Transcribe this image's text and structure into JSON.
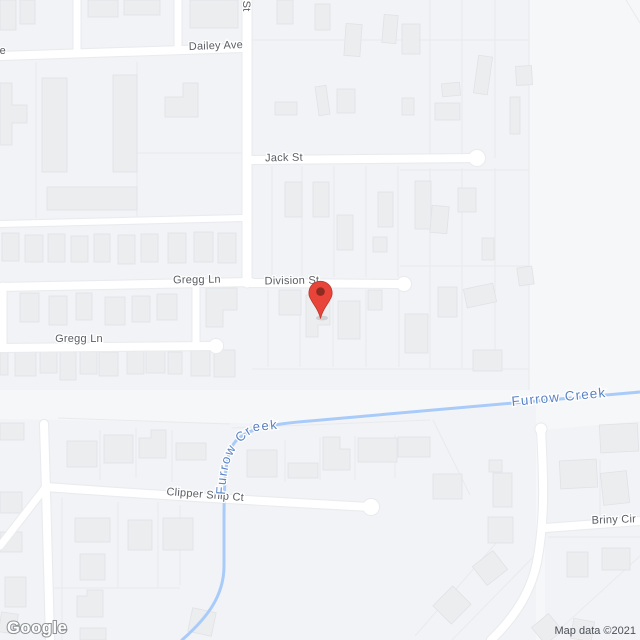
{
  "title": "Map",
  "logo": {
    "text": "Google"
  },
  "attribution": {
    "text": "Map data ©2021"
  },
  "pin": {
    "name": "red-location-pin",
    "color": "#e8443a",
    "inner_color": "#8e2b21"
  },
  "water": {
    "name": "Furrow Creek"
  },
  "colors": {
    "background": "#f6f7f9",
    "block": "#f2f3f6",
    "building": "#ebedef",
    "building_border": "#e0e2e6",
    "road": "#ffffff",
    "road_casing": "#e9ebee",
    "parcel_line": "#e8eaec",
    "creek": "#a9cbf9",
    "street_label": "#595d63",
    "water_label": "#5b82c4"
  },
  "street_labels": [
    {
      "id": "dailey-ave",
      "text": "Dailey Ave",
      "x": 216,
      "y": 49,
      "rotate": -2,
      "anchor": "middle"
    },
    {
      "id": "jack-st",
      "text": "Jack St",
      "x": 284,
      "y": 161,
      "rotate": -1,
      "anchor": "middle"
    },
    {
      "id": "gregg-ln-top",
      "text": "Gregg Ln",
      "x": 197,
      "y": 283,
      "rotate": -1,
      "anchor": "middle"
    },
    {
      "id": "division-st",
      "text": "Division St",
      "x": 292,
      "y": 284,
      "rotate": -1,
      "anchor": "middle"
    },
    {
      "id": "gregg-ln-bottom",
      "text": "Gregg Ln",
      "x": 79,
      "y": 342,
      "rotate": 0,
      "anchor": "middle"
    },
    {
      "id": "clipper-ship-ct",
      "text": "Clipper Ship Ct",
      "x": 205,
      "y": 498,
      "rotate": 4.5,
      "anchor": "middle"
    },
    {
      "id": "briny-cir",
      "text": "Briny Cir",
      "x": 614,
      "y": 523,
      "rotate": -2,
      "anchor": "middle"
    },
    {
      "id": "vertical-st-partial",
      "text": "n St",
      "x": 243,
      "y": -9,
      "rotate": 90,
      "anchor": "start"
    },
    {
      "id": "left-edge-fragment",
      "text": "e",
      "x": 6,
      "y": 54,
      "rotate": 0,
      "anchor": "end"
    }
  ],
  "water_labels": {
    "right": {
      "text": "Furrow Creek",
      "x": 512,
      "y": 406,
      "rotate": -5.5
    },
    "along_creek": {
      "text": "Furrow Creek"
    }
  },
  "features": {
    "blocks": [
      "M0,0 L529,0 L529,390 L0,390 Z",
      "M0,419 L300,424 L536,403 L536,640 L0,640 Z",
      "M545,430 L640,421 L640,640 L545,640 Z"
    ],
    "roads": [
      {
        "d": "M0,56 L243,48",
        "w": 8
      },
      {
        "d": "M247,0 L247,283",
        "w": 9
      },
      {
        "d": "M251,160 L477,158",
        "w": 8
      },
      {
        "d": "M251,283 L404,284",
        "w": 8
      },
      {
        "d": "M0,287 L251,282",
        "w": 8
      },
      {
        "d": "M196,284 L196,346",
        "w": 7
      },
      {
        "d": "M3,286 L3,347",
        "w": 7
      },
      {
        "d": "M0,348 L213,346",
        "w": 8
      },
      {
        "d": "M0,224 L243,218",
        "w": 6
      },
      {
        "d": "M77,0 L77,51",
        "w": 7
      },
      {
        "d": "M178,0 L178,50",
        "w": 7
      },
      {
        "d": "M46,487 C140,494 260,501 371,507",
        "w": 8
      },
      {
        "d": "M44,424 L46,490 L50,640",
        "w": 8
      },
      {
        "d": "M0,546 L45,488",
        "w": 7
      },
      {
        "d": "M541,429 C543,470 546,515 537,562 C531,592 514,618 491,640",
        "w": 8
      },
      {
        "d": "M545,528 L640,521",
        "w": 8
      }
    ],
    "culdesacs": [
      {
        "x": 477,
        "y": 158,
        "r": 8
      },
      {
        "x": 404,
        "y": 284,
        "r": 7
      },
      {
        "x": 216,
        "y": 346,
        "r": 7
      },
      {
        "x": 371,
        "y": 507,
        "r": 8
      },
      {
        "x": 541,
        "y": 429,
        "r": 5.5
      }
    ],
    "creek": "M640,392 C560,399 420,411 310,421 C270,424 246,429 235,442 C227,452 224,468 224,520 L224,566 C224,596 207,618 182,640",
    "creek_label_path": "M225,497 C226,462 233,443 256,431 L365,420",
    "parcels": [
      "M272,166 L272,277",
      "M302,166 L302,277",
      "M334,166 L334,277",
      "M366,166 L366,277",
      "M398,166 L398,277",
      "M430,0 L430,158",
      "M462,0 L462,158",
      "M495,0 L495,158",
      "M430,168 L430,368",
      "M462,168 L462,368",
      "M495,168 L495,368",
      "M529,0 L529,390",
      "M252,40 L529,40",
      "M400,170 L529,170",
      "M400,266 L529,266",
      "M252,369 L529,369",
      "M268,290 L268,367",
      "M300,290 L300,367",
      "M333,290 L333,367",
      "M366,290 L366,367",
      "M399,290 L399,367",
      "M36,62 L36,218",
      "M137,62 L137,218",
      "M137,153 L243,153",
      "M626,0 L640,23",
      "M62,498 L62,640",
      "M118,502 L118,588",
      "M158,502 L158,588",
      "M48,588 L180,588",
      "M180,505 L180,585",
      "M100,430 L100,480",
      "M136,428 L136,478",
      "M172,430 L172,482",
      "M58,418 L230,424",
      "M285,440 L285,482",
      "M320,437 L320,480",
      "M355,436 L355,480",
      "M395,435 L395,478",
      "M433,420 L470,495",
      "M232,428 L430,420",
      "M415,636 L510,527",
      "M452,640 L540,550",
      "M548,537 L640,537",
      "M600,460 L600,520",
      "M548,640 L640,556"
    ],
    "buildings": [
      [
        0,
        0,
        16,
        30
      ],
      [
        20,
        0,
        15,
        24
      ],
      [
        88,
        0,
        30,
        17
      ],
      [
        124,
        0,
        36,
        15
      ],
      [
        190,
        0,
        48,
        28
      ],
      [
        277,
        0,
        16,
        24
      ],
      [
        315,
        4,
        15,
        26
      ],
      [
        345,
        24,
        16,
        32,
        4
      ],
      [
        383,
        15,
        14,
        28,
        5
      ],
      [
        402,
        24,
        18,
        30
      ],
      [
        317,
        86,
        11,
        29,
        -8
      ],
      [
        337,
        89,
        18,
        24
      ],
      [
        275,
        102,
        22,
        13
      ],
      [
        402,
        98,
        12,
        17
      ],
      [
        476,
        56,
        14,
        38,
        8
      ],
      [
        442,
        83,
        18,
        13,
        -5
      ],
      [
        435,
        103,
        25,
        17
      ],
      [
        510,
        97,
        10,
        37
      ],
      [
        516,
        66,
        16,
        19,
        -3
      ],
      [
        42,
        78,
        25,
        94
      ],
      [
        113,
        75,
        24,
        97
      ],
      [
        47,
        187,
        90,
        23
      ],
      [
        2,
        233,
        17,
        28
      ],
      [
        25,
        235,
        18,
        27
      ],
      [
        48,
        234,
        17,
        28
      ],
      [
        71,
        236,
        17,
        26
      ],
      [
        94,
        234,
        16,
        28
      ],
      [
        118,
        235,
        17,
        29
      ],
      [
        141,
        234,
        17,
        28
      ],
      [
        168,
        233,
        18,
        30
      ],
      [
        194,
        232,
        19,
        30
      ],
      [
        218,
        233,
        18,
        30
      ],
      [
        20,
        293,
        19,
        29
      ],
      [
        49,
        296,
        18,
        29
      ],
      [
        76,
        293,
        16,
        27
      ],
      [
        105,
        297,
        20,
        28
      ],
      [
        132,
        296,
        18,
        26
      ],
      [
        157,
        294,
        20,
        26
      ],
      [
        0,
        349,
        8,
        26
      ],
      [
        15,
        350,
        21,
        26
      ],
      [
        40,
        350,
        17,
        23
      ],
      [
        60,
        352,
        16,
        28
      ],
      [
        80,
        350,
        17,
        24
      ],
      [
        99,
        352,
        19,
        24
      ],
      [
        127,
        350,
        17,
        24
      ],
      [
        146,
        350,
        19,
        23
      ],
      [
        168,
        352,
        14,
        22
      ],
      [
        191,
        348,
        19,
        28
      ],
      [
        214,
        350,
        21,
        27
      ],
      [
        285,
        182,
        17,
        35
      ],
      [
        313,
        182,
        16,
        35
      ],
      [
        337,
        215,
        16,
        35
      ],
      [
        378,
        192,
        15,
        35
      ],
      [
        373,
        237,
        14,
        15
      ],
      [
        415,
        181,
        16,
        48
      ],
      [
        431,
        206,
        17,
        27,
        5
      ],
      [
        458,
        188,
        18,
        24
      ],
      [
        482,
        238,
        12,
        22
      ],
      [
        279,
        290,
        22,
        25
      ],
      [
        338,
        301,
        22,
        38
      ],
      [
        368,
        290,
        14,
        20
      ],
      [
        405,
        314,
        23,
        39
      ],
      [
        438,
        287,
        19,
        30
      ],
      [
        465,
        286,
        30,
        19,
        -12
      ],
      [
        518,
        267,
        15,
        18,
        -8
      ],
      [
        473,
        350,
        29,
        21
      ],
      [
        0,
        423,
        24,
        17
      ],
      [
        67,
        441,
        30,
        26
      ],
      [
        104,
        435,
        29,
        28
      ],
      [
        176,
        443,
        30,
        17
      ],
      [
        0,
        492,
        22,
        21
      ],
      [
        0,
        532,
        22,
        20
      ],
      [
        5,
        577,
        21,
        30
      ],
      [
        0,
        613,
        17,
        20,
        8
      ],
      [
        75,
        518,
        35,
        24
      ],
      [
        80,
        554,
        25,
        26
      ],
      [
        128,
        520,
        24,
        30
      ],
      [
        163,
        518,
        30,
        32
      ],
      [
        80,
        628,
        26,
        12
      ],
      [
        247,
        450,
        30,
        27
      ],
      [
        288,
        463,
        30,
        15
      ],
      [
        358,
        438,
        39,
        24
      ],
      [
        398,
        437,
        32,
        20
      ],
      [
        433,
        474,
        29,
        25
      ],
      [
        489,
        460,
        13,
        12
      ],
      [
        493,
        473,
        19,
        34
      ],
      [
        488,
        517,
        25,
        26
      ],
      [
        477,
        556,
        26,
        24,
        -38
      ],
      [
        438,
        592,
        28,
        26,
        -45
      ],
      [
        190,
        610,
        24,
        24,
        12
      ],
      [
        536,
        618,
        22,
        22,
        -40
      ],
      [
        560,
        460,
        37,
        28,
        -3
      ],
      [
        602,
        472,
        26,
        32,
        -6
      ],
      [
        567,
        552,
        21,
        25
      ],
      [
        602,
        548,
        28,
        22
      ],
      [
        572,
        620,
        21,
        20,
        10
      ],
      [
        600,
        424,
        38,
        28,
        -3
      ]
    ],
    "building_paths": [
      "M0,83 L12,83 L12,105 L27,105 L27,123 L12,123 L12,145 L0,145 Z",
      "M183,83 L198,83 L198,117 L165,117 L165,97 L183,97 Z",
      "M206,288 L237,288 L237,310 L223,310 L223,327 L206,327 Z",
      "M306,295 L330,295 L330,325 L318,325 L318,337 L306,337 Z",
      "M139,438 L151,438 L151,430 L166,430 L166,458 L139,458 Z",
      "M77,596 L87,596 L87,590 L103,590 L103,617 L77,617 Z",
      "M323,437 L340,437 L340,449 L350,449 L350,470 L323,470 Z"
    ]
  }
}
